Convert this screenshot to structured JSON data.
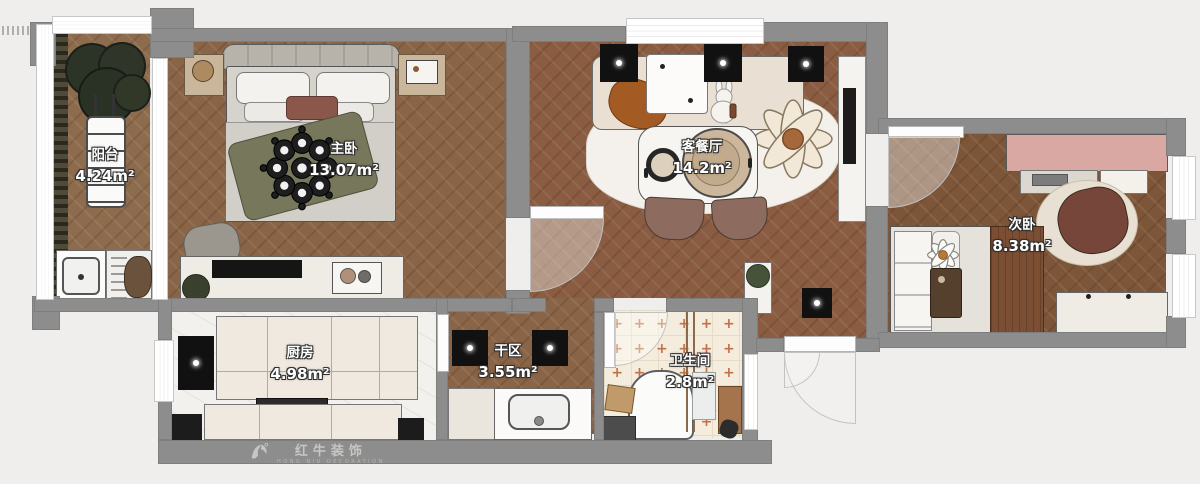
{
  "plan": {
    "rooms": [
      {
        "key": "balcony",
        "name": "阳台",
        "area": "4.24m²"
      },
      {
        "key": "master-bedroom",
        "name": "主卧",
        "area": "13.07m²"
      },
      {
        "key": "living-dining",
        "name": "客餐厅",
        "area": "14.2m²"
      },
      {
        "key": "second-bedroom",
        "name": "次卧",
        "area": "8.38m²"
      },
      {
        "key": "kitchen",
        "name": "厨房",
        "area": "4.98m²"
      },
      {
        "key": "dry-zone",
        "name": "干区",
        "area": "3.55m²"
      },
      {
        "key": "bathroom",
        "name": "卫生间",
        "area": "2.8m²"
      }
    ]
  },
  "watermark": {
    "brand": "红牛装饰",
    "tagline": "HONG NIU DECORATION"
  },
  "icons": {
    "ceiling_light": "spotlight-dot",
    "tile_cross": "+"
  },
  "colors": {
    "wall": "#8d8d8d",
    "wood": "#8a6446",
    "wood_red": "#8a5c41",
    "wood_dark": "#7d5639",
    "marble": "#f3f1ed",
    "tile": "#f4eddd",
    "tile_cross": "#c26a45",
    "desk_pink": "#d9a8a2",
    "accent_green": "#77775c",
    "accent_orange": "#a35a23"
  }
}
